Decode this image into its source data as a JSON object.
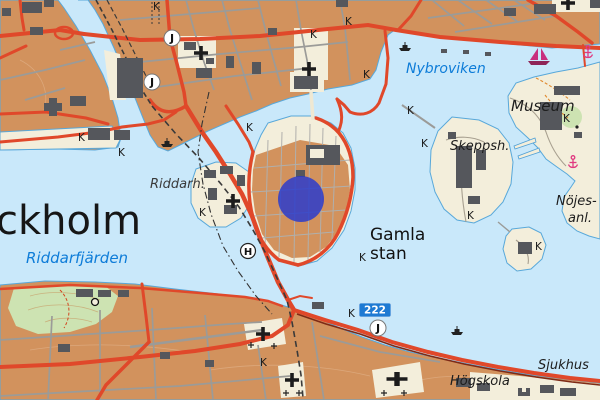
{
  "labels": {
    "city_partial": "ckholm",
    "riddarfjarden": "Riddarfjärden",
    "nybroviken": "Nybroviken",
    "museum": "Museum",
    "skeppsholmen_abbrev": "Skeppsh.",
    "nojes_line1": "Nöjes-",
    "nojes_line2": "anl.",
    "gamla_stan_line1": "Gamla",
    "gamla_stan_line2": "stan",
    "riddarholmen_abbrev": "Riddarh.",
    "sjukhus": "Sjukhus",
    "hogskola": "Högskola"
  },
  "symbols": {
    "rail_station_letter": "J",
    "helipad_letter": "H",
    "k": "K",
    "road_number_badge": "222"
  },
  "marker": {
    "shape": "circle",
    "color": "#2438cf",
    "opacity": 0.82,
    "center_x": 301,
    "center_y": 199,
    "radius": 23
  },
  "colors": {
    "water": "#c9e8fa",
    "land_urban_orange": "#d2925d",
    "land_light_cream": "#f3eedb",
    "park_green": "#cde3b2",
    "building_gray": "#55575c",
    "road_major_red": "#e0482a",
    "road_minor_gray": "#9b9b98",
    "railway_dark": "#3a3a3a",
    "rail_maroon": "#7e2a16",
    "water_label_blue": "#0d7cd8",
    "route_badge_blue": "#1e7ad3",
    "anchor_pink": "#e03a80"
  }
}
